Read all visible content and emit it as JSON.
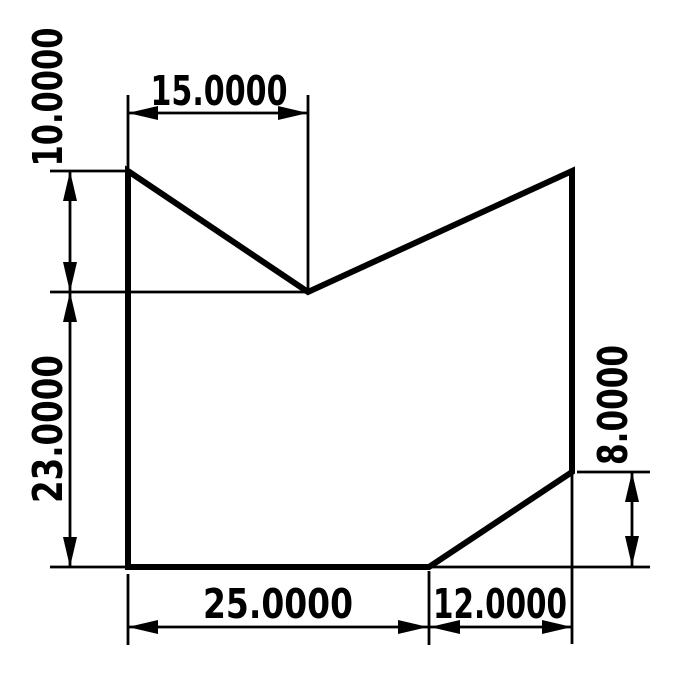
{
  "drawing": {
    "kind": "dimensioned-part-outline",
    "colors": {
      "background": "#ffffff",
      "line": "#000000",
      "text": "#000000"
    },
    "dimensions": [
      {
        "name": "notch-width-top",
        "value": "15.0000",
        "orientation": "horizontal"
      },
      {
        "name": "notch-depth-left",
        "value": "10.0000",
        "orientation": "vertical"
      },
      {
        "name": "left-height",
        "value": "23.0000",
        "orientation": "vertical"
      },
      {
        "name": "bottom-width-left",
        "value": "25.0000",
        "orientation": "horizontal"
      },
      {
        "name": "bottom-width-right",
        "value": "12.0000",
        "orientation": "horizontal"
      },
      {
        "name": "right-height",
        "value": "8.0000",
        "orientation": "vertical"
      }
    ]
  }
}
